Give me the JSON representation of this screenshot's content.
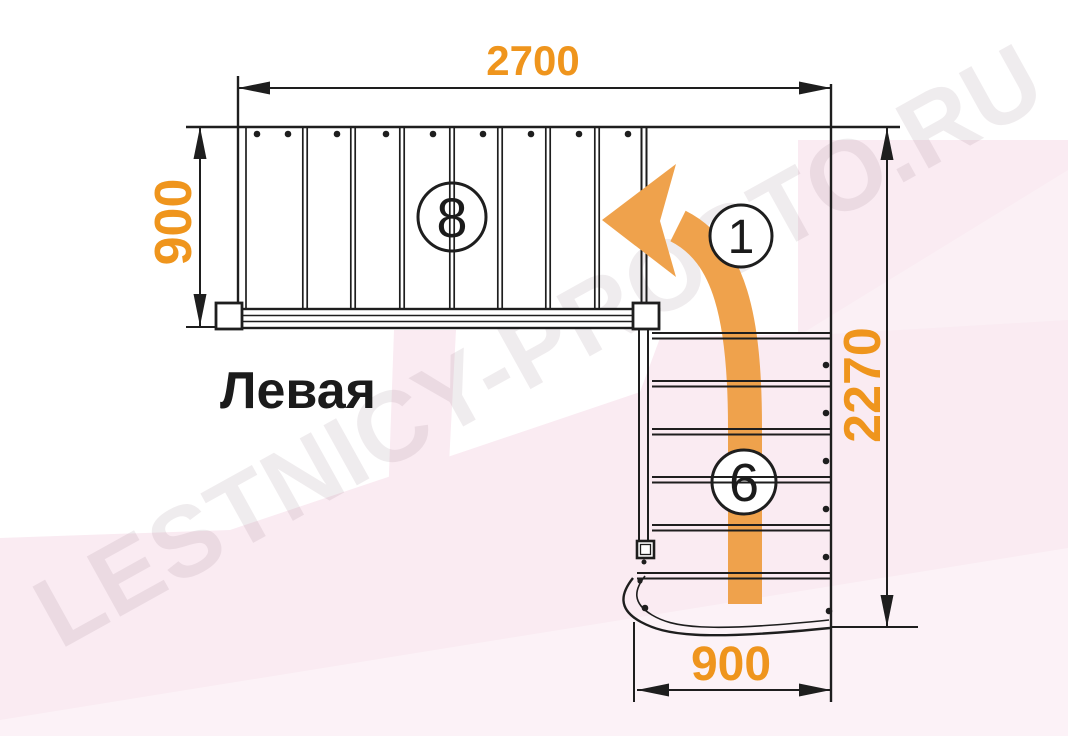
{
  "diagram": {
    "title": "Левая",
    "watermark": "LESTNICY-PROSTO.RU",
    "dimensions": {
      "top_width_mm": "2700",
      "left_depth_mm": "900",
      "right_height_mm": "2270",
      "bottom_width_mm": "900"
    },
    "step_labels": {
      "upper_flight": "8",
      "turn": "1",
      "lower_flight": "6"
    },
    "colors": {
      "dimension_text": "#EF951D",
      "arrow": "#EFA24C",
      "linework": "#1e1e1e",
      "background_tint": "#FAEBF2"
    }
  }
}
